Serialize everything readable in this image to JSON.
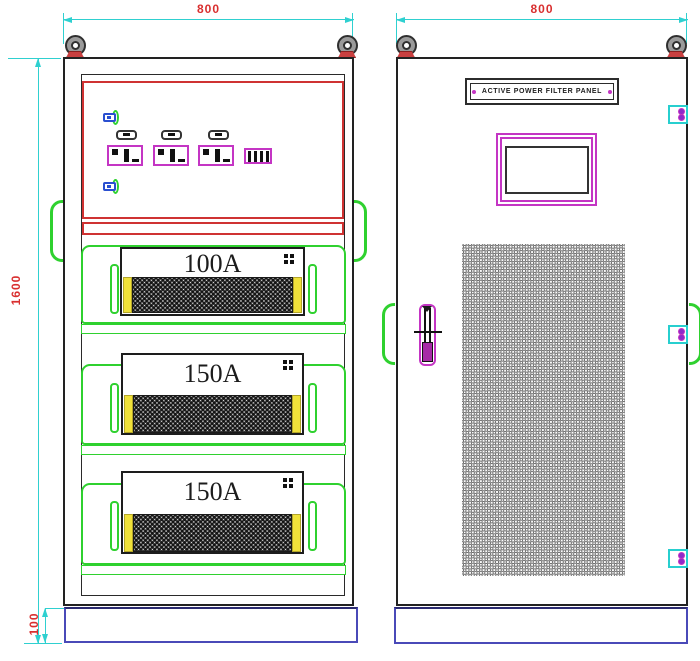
{
  "drawing": {
    "dim_left_width": "800",
    "dim_right_width": "800",
    "dim_height": "1600",
    "dim_base_height": "100",
    "nameplate_text": "ACTIVE POWER FILTER PANEL",
    "modules": [
      {
        "label": "100A"
      },
      {
        "label": "150A"
      },
      {
        "label": "150A"
      }
    ],
    "colors": {
      "dimension_line": "#2fd0d0",
      "dimension_text": "#d92f2f",
      "outline": "#222222",
      "compartment_border": "#cf3232",
      "rail_green": "#2fd12f",
      "magenta": "#c435c4",
      "base_blue": "#4a4ab8",
      "lug_blue": "#2a4fd0",
      "yellow": "#f0e13a"
    }
  }
}
